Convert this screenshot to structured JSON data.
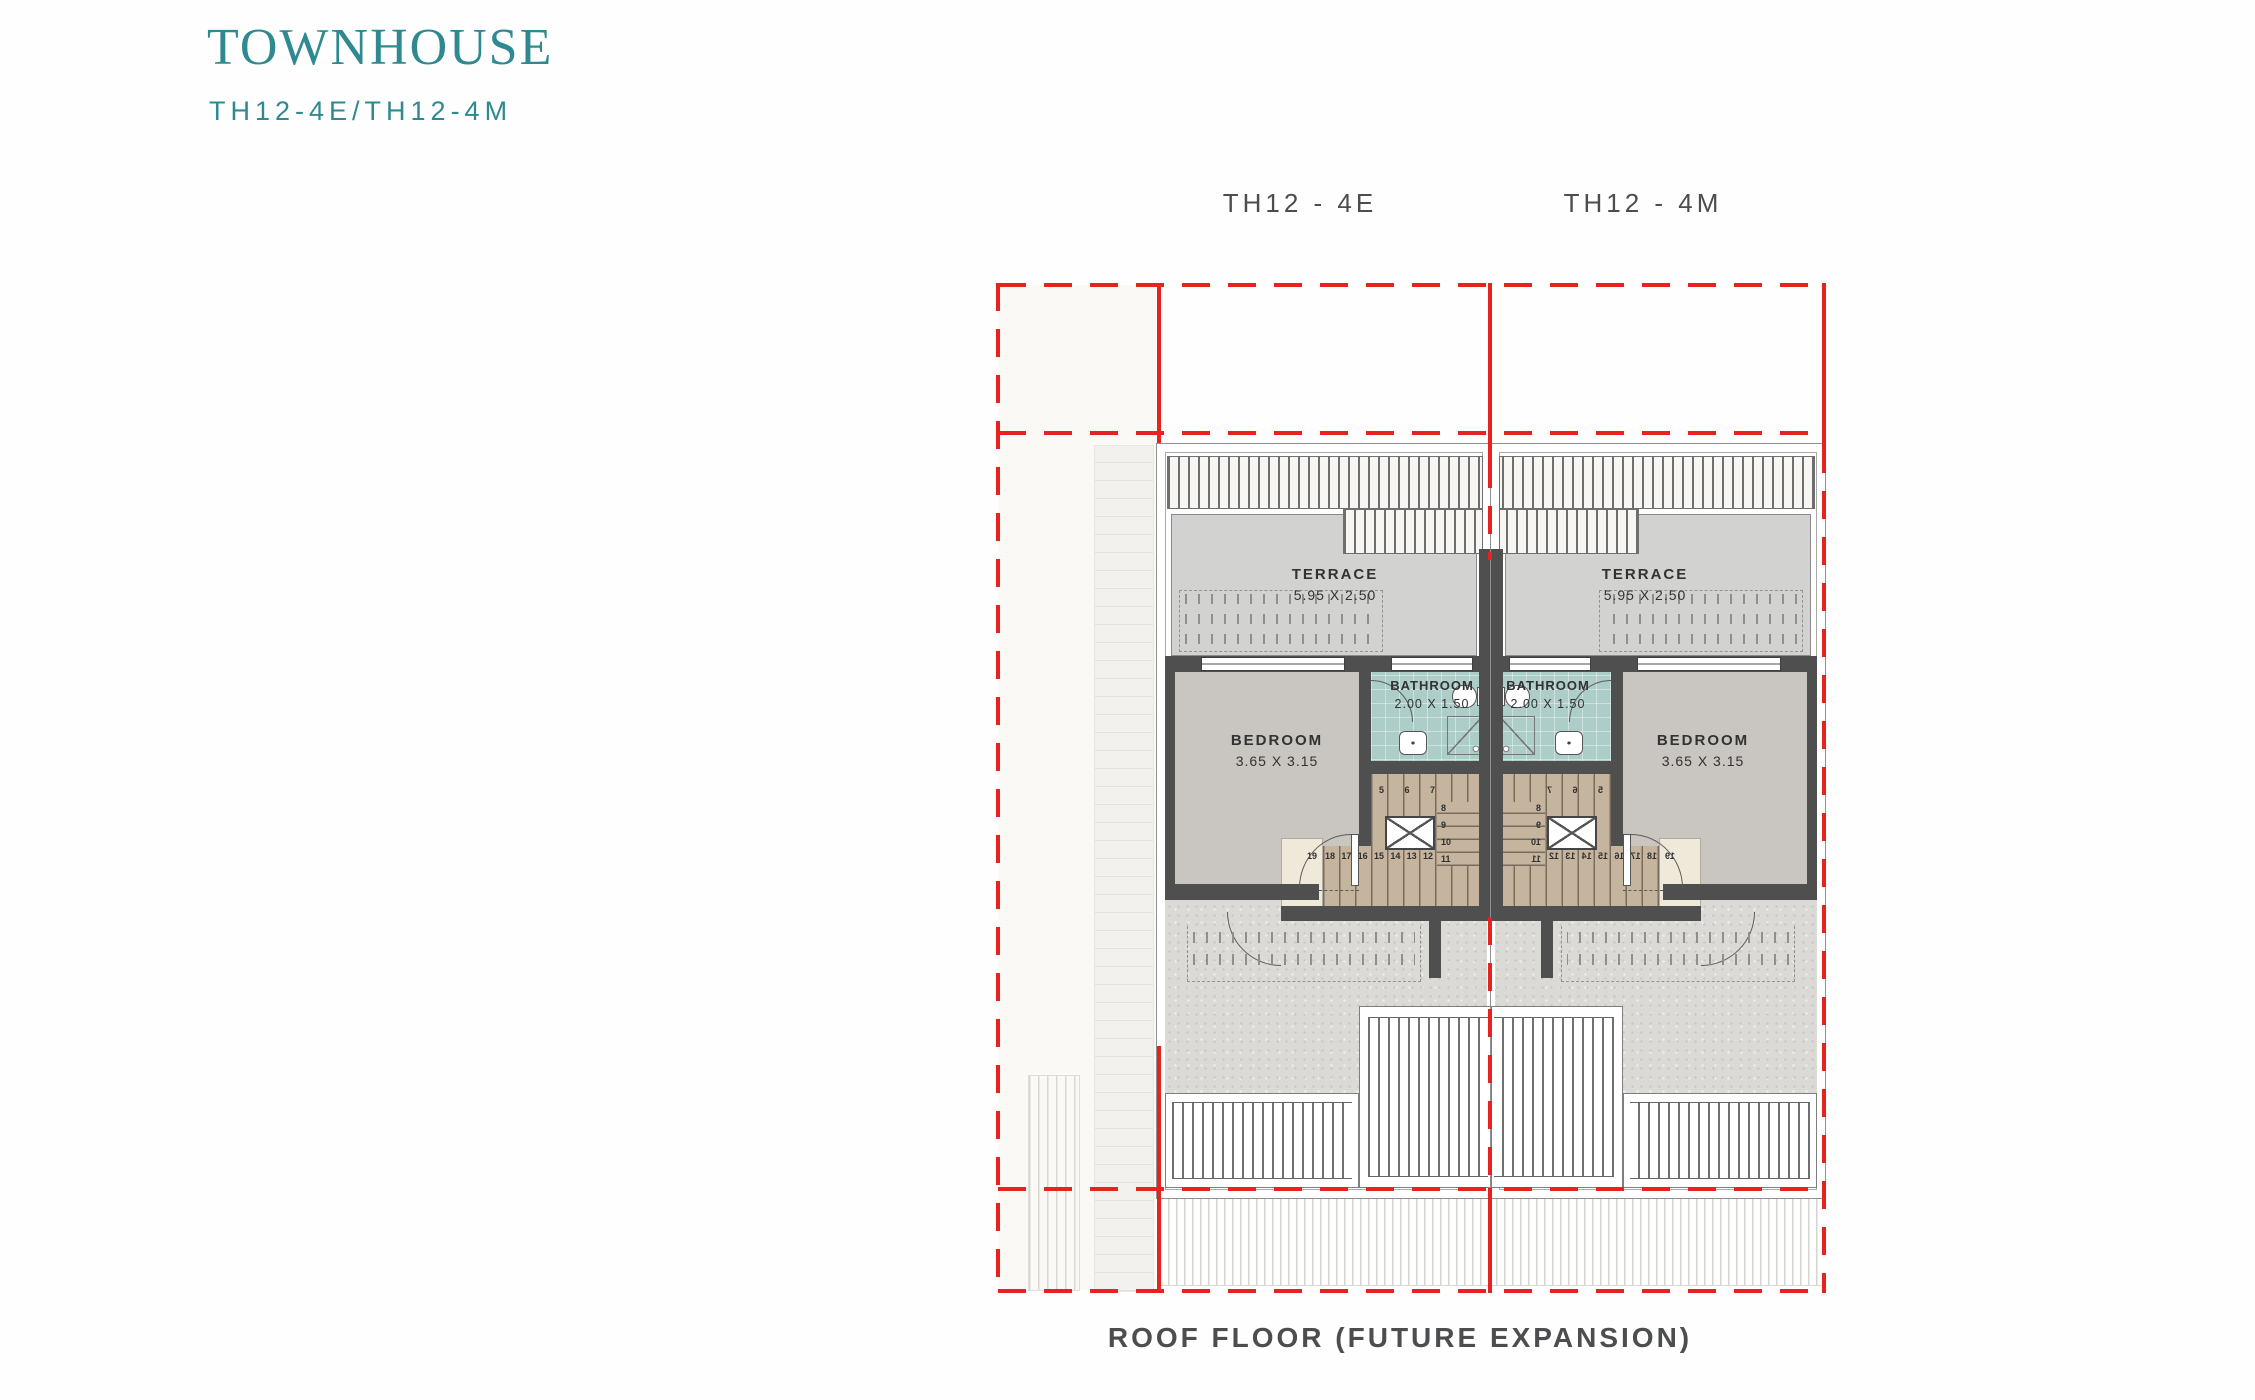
{
  "header": {
    "title": "TOWNHOUSE",
    "subtitle": "TH12-4E/TH12-4M"
  },
  "units": {
    "left": {
      "label": "TH12 - 4E"
    },
    "right": {
      "label": "TH12 - 4M"
    }
  },
  "caption": "ROOF FLOOR (FUTURE EXPANSION)",
  "rooms": {
    "terrace": {
      "name": "TERRACE",
      "dims": "5.95 X 2.50"
    },
    "bedroom": {
      "name": "BEDROOM",
      "dims": "3.65 X 3.15"
    },
    "bathroom": {
      "name": "BATHROOM",
      "dims": "2.00 X 1.50"
    }
  },
  "stairs": {
    "top": [
      "5",
      "6",
      "7"
    ],
    "right_col": [
      "8",
      "9",
      "10",
      "11"
    ],
    "bottom": [
      "12",
      "13",
      "14",
      "15",
      "16",
      "17",
      "18"
    ],
    "landing": "19"
  },
  "colors": {
    "accent_teal": "#2E8A90",
    "line_red": "#E8231F",
    "wall_dark": "#4F4F4F",
    "label_gray": "#4C4D4F",
    "bedroom_floor": "#C9C5C0",
    "terrace_floor": "#D2D3D1",
    "bathroom_floor": "#ACCDC8",
    "stair_wood": "#C6B59E",
    "landing_cream": "#EFE9DA",
    "gravel_roof": "#DCDAD6"
  }
}
